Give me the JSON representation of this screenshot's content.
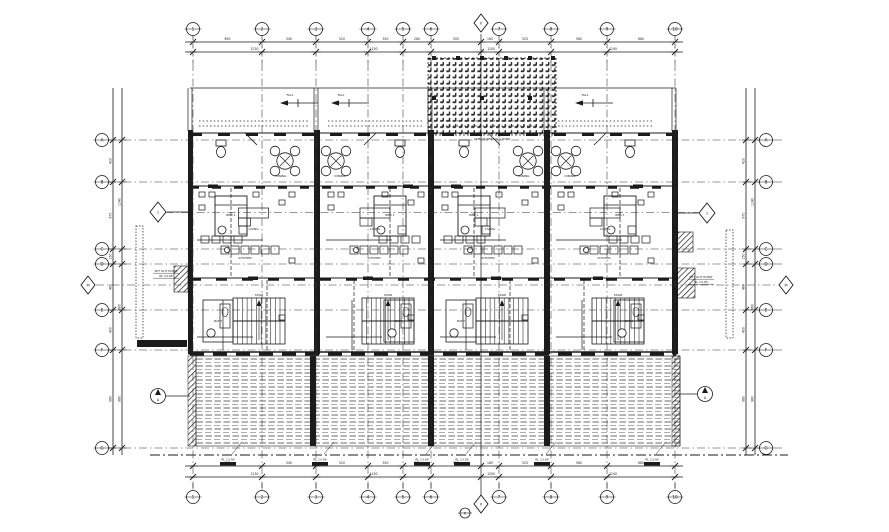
{
  "meta": {
    "bg": "#ffffff",
    "ink": "#1b1b1b",
    "faint": "#3a3a3a"
  },
  "grid": {
    "vxs": [
      193,
      262,
      316,
      368,
      403,
      431,
      499,
      551,
      607,
      675
    ],
    "hys": [
      140,
      182,
      249,
      264,
      310,
      350,
      448
    ],
    "top_labels": [
      "1",
      "2",
      "3",
      "4",
      "5",
      "6",
      "7",
      "8",
      "9",
      "10"
    ],
    "bottom_labels": [
      "1",
      "2",
      "3",
      "4",
      "5",
      "6",
      "7",
      "8",
      "9",
      "10"
    ],
    "left_labels": [
      "A",
      "B",
      "C",
      "D",
      "E",
      "F",
      "G"
    ],
    "right_labels": [
      "A",
      "B",
      "C",
      "D",
      "E",
      "F",
      "G"
    ],
    "diamond_top": {
      "x": 481,
      "y": 23,
      "label": "X"
    },
    "diamond_bottom": {
      "x": 481,
      "y": 504,
      "label": "X"
    },
    "circle_bottom_small": {
      "x": 465,
      "y": 513,
      "label": "x"
    },
    "diamond_left": {
      "x": 88,
      "y": 285,
      "label": "M"
    },
    "diamond_right": {
      "x": 786,
      "y": 285,
      "label": "M"
    }
  },
  "dims": {
    "top_row1": [
      "690",
      "540",
      "520",
      "350",
      "280",
      "500",
      "180",
      "520",
      "560",
      "680"
    ],
    "top_row2": [
      "1230",
      "1150",
      "1200",
      "1240"
    ],
    "top_row2_pts": [
      193,
      316,
      431,
      551,
      675
    ],
    "bottom_row1": [
      "690",
      "540",
      "520",
      "350",
      "280",
      "500",
      "180",
      "520",
      "560",
      "680"
    ],
    "bottom_row2": [
      "1230",
      "1150",
      "1200",
      "1240"
    ],
    "left_row1": [
      "420",
      "670",
      "150",
      "460",
      "400",
      "980"
    ],
    "left_row2": [
      "1240",
      "860",
      "980"
    ],
    "left_row2_pts": [
      140,
      264,
      350,
      448
    ],
    "right_row1": [
      "420",
      "670",
      "150",
      "460",
      "400",
      "980"
    ],
    "right_row2": [
      "1240",
      "860",
      "980"
    ]
  },
  "building": {
    "units": [
      {
        "x0": 193,
        "w": 121,
        "flip": false
      },
      {
        "x0": 322,
        "w": 106,
        "flip": true
      },
      {
        "x0": 436,
        "w": 108,
        "flip": false
      },
      {
        "x0": 552,
        "w": 106,
        "flip": true
      }
    ],
    "room_labels": [
      "LIVING",
      "DINING",
      "KITCHEN",
      "BED 1",
      "BATH",
      "STAIR"
    ]
  },
  "markers": {
    "section_diamond_left": "1",
    "section_diamond_right": "1",
    "section_circle_left": "A",
    "section_circle_right": "A",
    "fall_arrows": [
      290,
      341,
      585
    ]
  },
  "deck_tags": [
    {
      "x": 228,
      "label": "RL 13.90"
    },
    {
      "x": 320,
      "label": "RL 13.90"
    },
    {
      "x": 422,
      "label": "RL 13.90"
    },
    {
      "x": 462,
      "label": "RL 13.85"
    },
    {
      "x": 542,
      "label": "RL 13.90"
    },
    {
      "x": 652,
      "label": "RL 13.90"
    }
  ],
  "annotations": [
    {
      "x": 701,
      "y": 278,
      "t": "SET OUT POINT",
      "ul": 1
    },
    {
      "x": 701,
      "y": 283,
      "t": "RL 13.95",
      "ul": 1
    },
    {
      "x": 166,
      "y": 272,
      "t": "SET OUT POINT",
      "ul": 1
    },
    {
      "x": 166,
      "y": 277,
      "t": "RL 13.95",
      "ul": 1
    },
    {
      "x": 492,
      "y": 140,
      "t": "LINE OF PERGOLA OVER",
      "ul": 0
    },
    {
      "x": 290,
      "y": 96,
      "t": "FALL",
      "ul": 0
    },
    {
      "x": 341,
      "y": 96,
      "t": "FALL",
      "ul": 0
    },
    {
      "x": 585,
      "y": 96,
      "t": "FALL",
      "ul": 0
    }
  ]
}
